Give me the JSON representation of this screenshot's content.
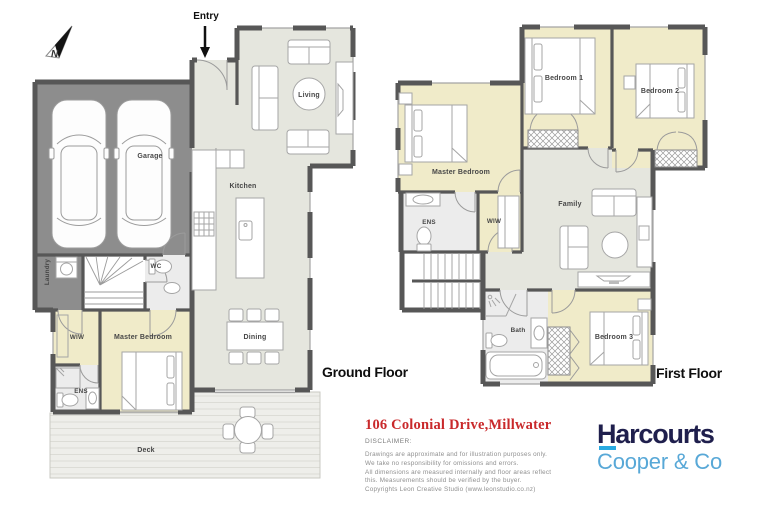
{
  "north": {
    "label": "N"
  },
  "entry": {
    "label": "Entry"
  },
  "ground_floor": {
    "title": "Ground Floor",
    "rooms": {
      "garage": "Garage",
      "living": "Living",
      "kitchen": "Kitchen",
      "dining": "Dining",
      "wc": "WC",
      "laundry": "Laundry",
      "wiw": "WIW",
      "master": "Master Bedroom",
      "ens": "ENS",
      "deck": "Deck"
    }
  },
  "first_floor": {
    "title": "First Floor",
    "rooms": {
      "master": "Master Bedroom",
      "bedroom1": "Bedroom 1",
      "bedroom2": "Bedroom 2",
      "family": "Family",
      "ens": "ENS",
      "wiw": "WIW",
      "bath": "Bath",
      "bedroom3": "Bedroom 3"
    }
  },
  "footer": {
    "address": "106 Colonial Drive,Millwater",
    "disclaimer_title": "DISCLAIMER:",
    "disclaimer_lines": [
      "Drawings are approximate and for illustration purposes only.",
      "We take no responsibility for omissions and errors.",
      "All dimensions are measured internally and floor areas reflect",
      "this. Measurements should be verified by the buyer.",
      "Copyrights Leon Creative Studio (www.leonstudio.co.nz)"
    ]
  },
  "brand": {
    "name": "Harcourts",
    "subname": "Cooper & Co"
  },
  "colors": {
    "address_red": "#c9292b",
    "brand_navy": "#1f1f4d",
    "brand_blue": "#58a8d7",
    "brand_underline": "#29aae1",
    "wall": "#575757",
    "floor_main": "#e5e6de",
    "floor_bedroom": "#f0ebc9",
    "floor_garage": "#8d8d8d"
  }
}
